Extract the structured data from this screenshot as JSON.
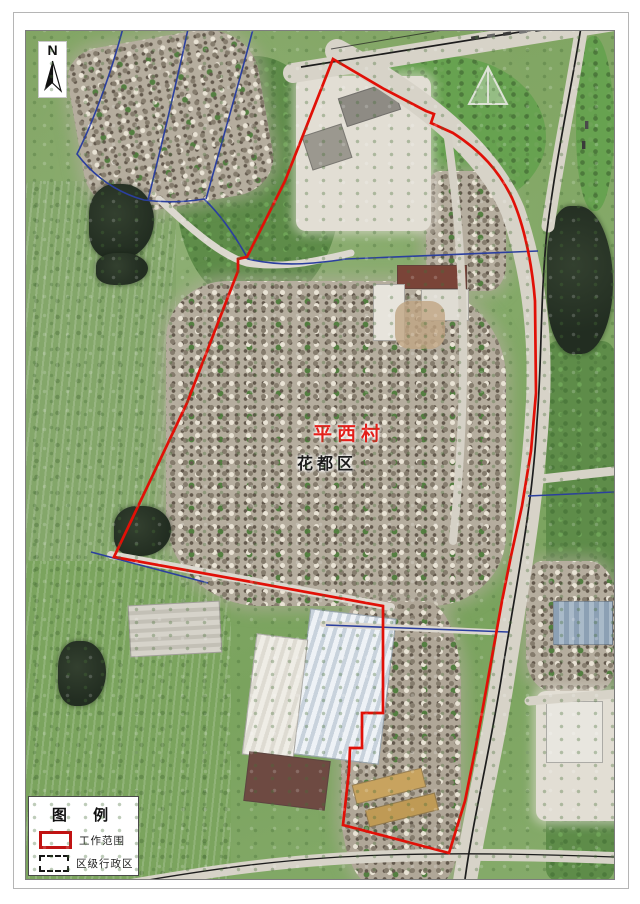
{
  "north_arrow": {
    "label": "N"
  },
  "labels": {
    "village": {
      "text": "平西村",
      "color": "#e31f1a"
    },
    "district": {
      "text": "花都区",
      "color": "#1b1b1b"
    }
  },
  "legend": {
    "title": "图 例",
    "items": [
      {
        "label": "工作范围",
        "style": "red-solid-rectangle",
        "color": "#c11212"
      },
      {
        "label": "区级行政区",
        "style": "black-dashed-rectangle",
        "color": "#141414"
      }
    ]
  },
  "map_colors": {
    "work_boundary_red": "#e11007",
    "admin_boundary_blue": "#2b3f9e",
    "road_edge_black": "#1d1d1d",
    "vegetation_green": "#7ea25f",
    "water_dark": "#273226",
    "road_fill": "#d7d3c8"
  }
}
